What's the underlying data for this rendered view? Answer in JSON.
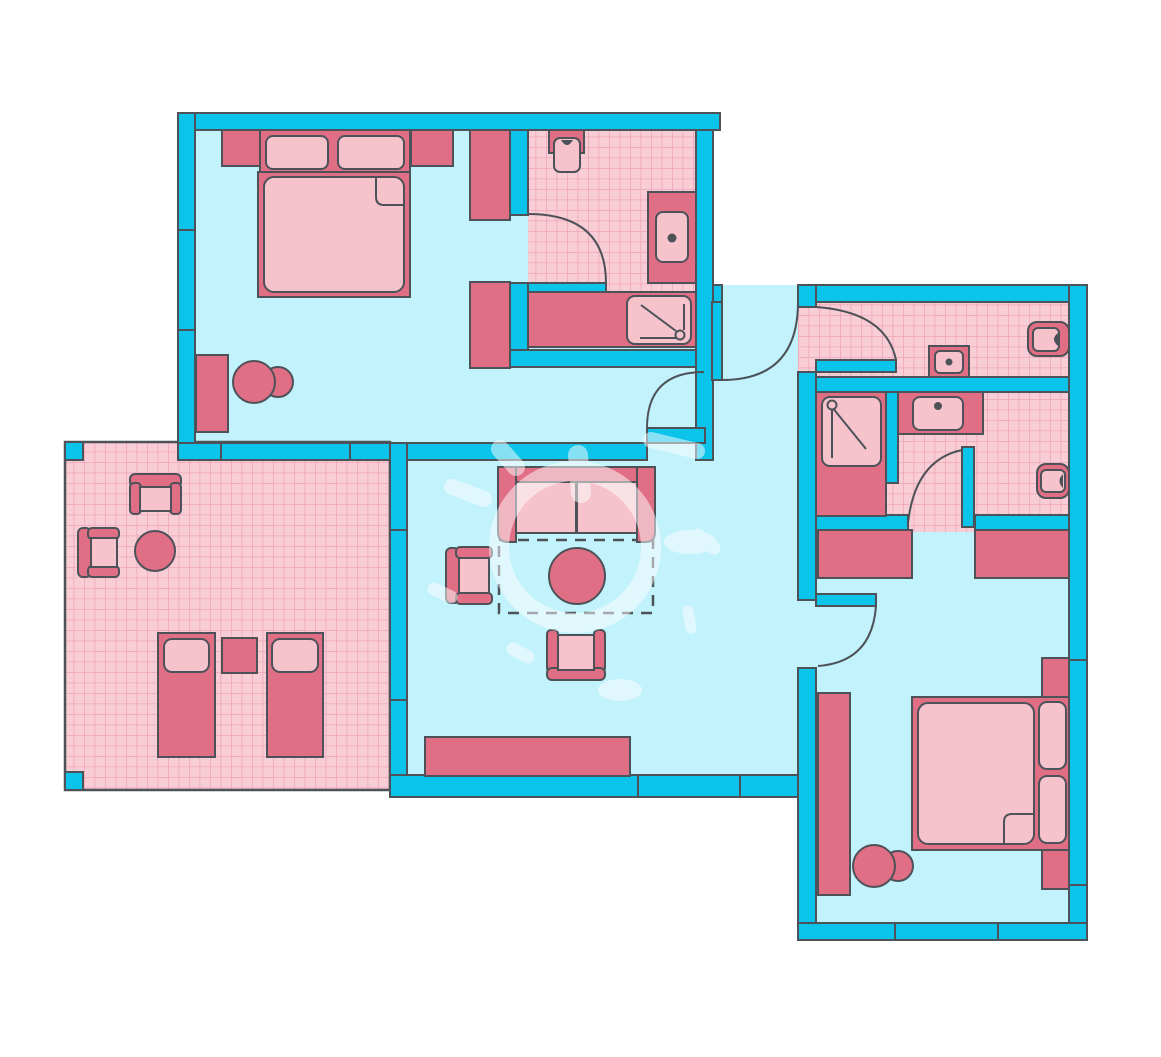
{
  "document": {
    "kind": "apartment-floor-plan",
    "visible_text": "none",
    "canvas": {
      "width": 1161,
      "height": 1057,
      "background": "#ffffff"
    }
  },
  "colors": {
    "wall": "#0cc3e9",
    "outline": "#4d5259",
    "floor": "#c2f2fb",
    "furnDark": "#e06e84",
    "furnLight": "#f6c3cd",
    "tileBg": "#f8cdd6",
    "tileLine": "#efa5b6",
    "watermark": "#ffffff"
  },
  "rooms": [
    {
      "name": "bedroom-top-left",
      "floor": "plain",
      "furniture": [
        "double-bed",
        "pillow",
        "pillow",
        "folded-sheet-corner",
        "nightstand-left",
        "nightstand-right",
        "wardrobe-upper",
        "wardrobe-lower",
        "dresser",
        "stool-pair"
      ]
    },
    {
      "name": "bathroom-top-left",
      "floor": "tiled",
      "fixtures": [
        "toilet",
        "washbasin-counter",
        "vanity-counter",
        "shower-tray"
      ],
      "door": "swing-into-bathroom"
    },
    {
      "name": "terrace-left",
      "floor": "tiled",
      "railing": true,
      "furniture": [
        "armchair-facing-down",
        "armchair-facing-right",
        "round-table",
        "lounger",
        "side-table",
        "lounger"
      ]
    },
    {
      "name": "living-room-center",
      "floor": "plain",
      "furniture": [
        "sofa-two-seat",
        "armchair-facing-right",
        "armchair-facing-up",
        "round-coffee-table",
        "dashed-rug-outline",
        "sideboard"
      ]
    },
    {
      "name": "entry-hall",
      "floor": "plain",
      "doors": [
        "entrance-door",
        "door-to-bedroom-top-left",
        "door-to-bathroom-right-upper"
      ]
    },
    {
      "name": "bathroom-right-upper",
      "floor": "tiled",
      "fixtures": [
        "washbasin",
        "toilet"
      ],
      "door": "swing-into-bathroom"
    },
    {
      "name": "bathroom-right-lower",
      "floor": "tiled",
      "fixtures": [
        "shower-tray",
        "washbasin-counter",
        "toilet"
      ],
      "door": "swing-into-bathroom"
    },
    {
      "name": "bedroom-bottom-right",
      "floor": "plain",
      "furniture": [
        "wardrobe-left",
        "wardrobe-right",
        "double-bed",
        "pillow",
        "pillow",
        "folded-sheet-corner",
        "nightstand-upper",
        "nightstand-lower",
        "tall-wardrobe",
        "stool-pair"
      ]
    }
  ],
  "openings": {
    "doors": 6,
    "window_tick_marks": [
      "bedroom-left-wall-x2",
      "bedroom-bottom-wall-x2",
      "living-west-wall-x2",
      "living-bottom-wall-x2",
      "bedroom-right-bottom-wall-x2",
      "apartment-right-wall-x2"
    ]
  },
  "watermark": {
    "present": true,
    "color": "#ffffff",
    "opacity": 0.5,
    "shape": "pills-and-ring-over-living-room"
  }
}
